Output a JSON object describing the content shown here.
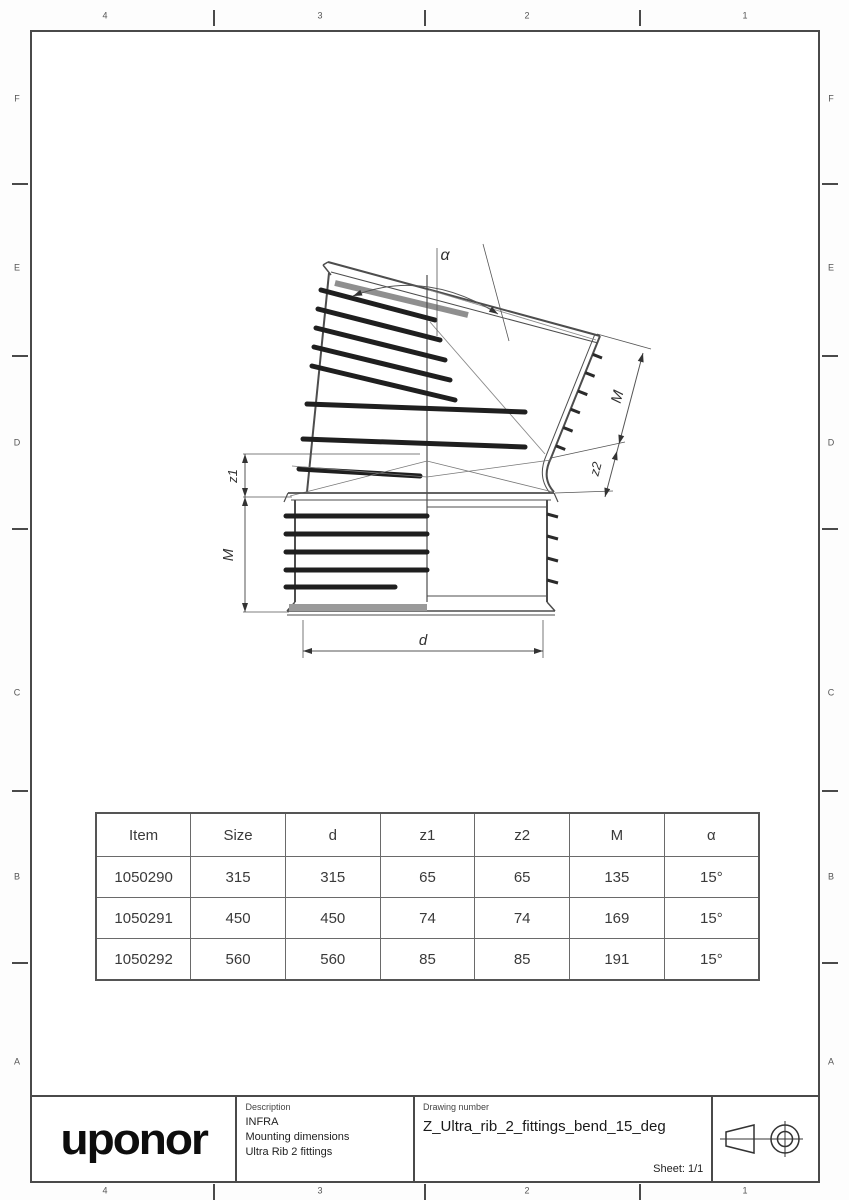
{
  "sheet": {
    "zones_top": [
      "4",
      "3",
      "2",
      "1"
    ],
    "zones_bottom": [
      "4",
      "3",
      "2",
      "1"
    ],
    "zones_left": [
      "F",
      "E",
      "D",
      "C",
      "B",
      "A"
    ],
    "zones_right": [
      "F",
      "E",
      "D",
      "C",
      "B",
      "A"
    ]
  },
  "drawing": {
    "labels": {
      "angle": "α",
      "m_upper": "M",
      "z2": "z2",
      "z1": "z1",
      "m_lower": "M",
      "d": "d"
    }
  },
  "table": {
    "headers": [
      "Item",
      "Size",
      "d",
      "z1",
      "z2",
      "M",
      "α"
    ],
    "rows": [
      [
        "1050290",
        "315",
        "315",
        "65",
        "65",
        "135",
        "15°"
      ],
      [
        "1050291",
        "450",
        "450",
        "74",
        "74",
        "169",
        "15°"
      ],
      [
        "1050292",
        "560",
        "560",
        "85",
        "85",
        "191",
        "15°"
      ]
    ]
  },
  "title_block": {
    "logo": "uponor",
    "description_label": "Description",
    "description_lines": [
      "INFRA",
      "Mounting dimensions",
      "Ultra Rib 2 fittings"
    ],
    "drawing_number_label": "Drawing number",
    "drawing_number": "Z_Ultra_rib_2_fittings_bend_15_deg",
    "sheet_label": "Sheet: 1/1"
  },
  "colors": {
    "line": "#4d4d4d",
    "rib": "#1f1f1f",
    "dim": "#555555",
    "text": "#333333",
    "accent_gray": "#8f8f8f"
  }
}
